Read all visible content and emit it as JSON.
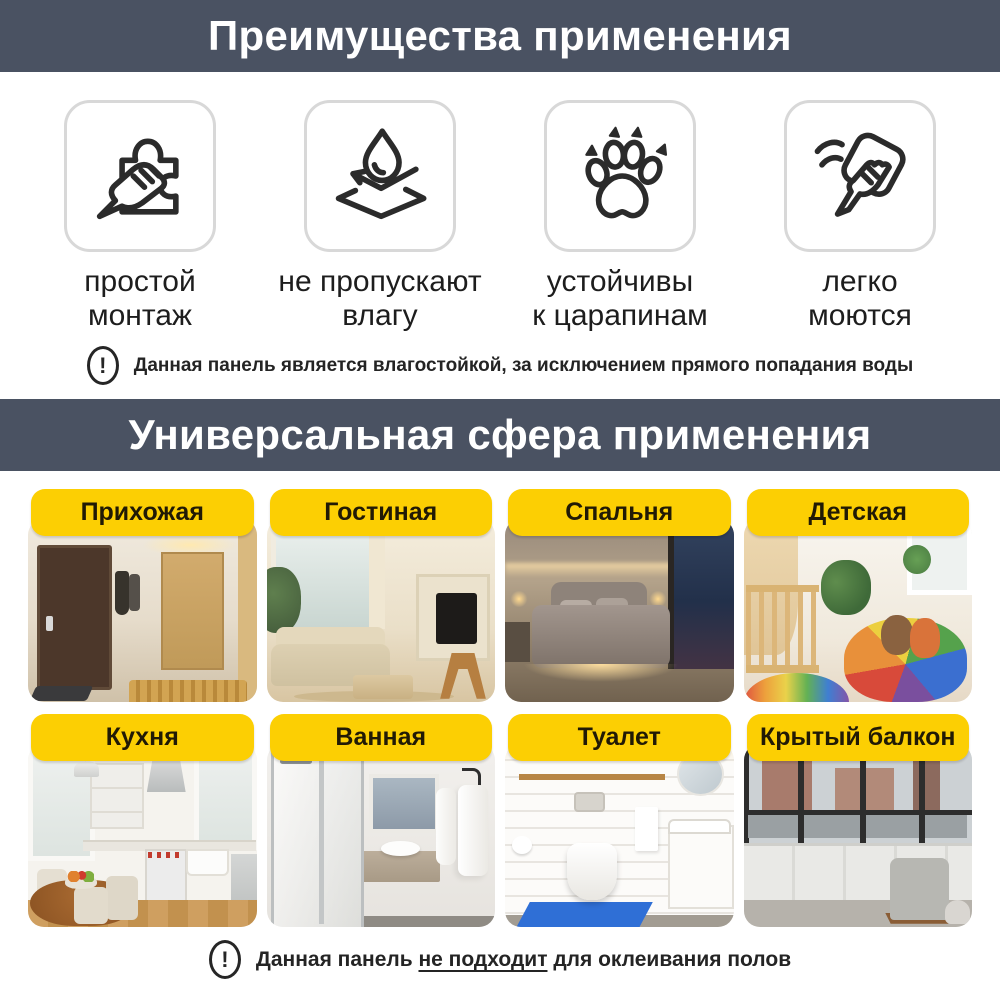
{
  "colors": {
    "header_bg": "#4a5262",
    "accent": "#fccf03",
    "pill_text": "#211a05",
    "icon_stroke": "#2b2b2b"
  },
  "icons": {
    "exclamation": "!"
  },
  "header1": {
    "title": "Преимущества применения"
  },
  "benefits": {
    "items": [
      {
        "icon": "puzzle-hand-icon",
        "line1": "простой",
        "line2": "монтаж"
      },
      {
        "icon": "water-drop-surface-icon",
        "line1": "не пропускают",
        "line2": "влагу"
      },
      {
        "icon": "paw-icon",
        "line1": "устойчивы",
        "line2": "к царапинам"
      },
      {
        "icon": "wipe-cloth-icon",
        "line1": "легко",
        "line2": "моются"
      }
    ]
  },
  "note1": {
    "text": "Данная панель является влагостойкой, за исключением прямого попадания воды"
  },
  "header2": {
    "title": "Универсальная сфера применения"
  },
  "rooms": {
    "items": [
      {
        "label": "Прихожая"
      },
      {
        "label": "Гостиная"
      },
      {
        "label": "Спальня"
      },
      {
        "label": "Детская"
      },
      {
        "label": "Кухня"
      },
      {
        "label": "Ванная"
      },
      {
        "label": "Туалет"
      },
      {
        "label": "Крытый балкон"
      }
    ]
  },
  "note2": {
    "prefix": "Данная панель ",
    "underlined": "не подходит",
    "suffix": " для оклеивания полов"
  }
}
